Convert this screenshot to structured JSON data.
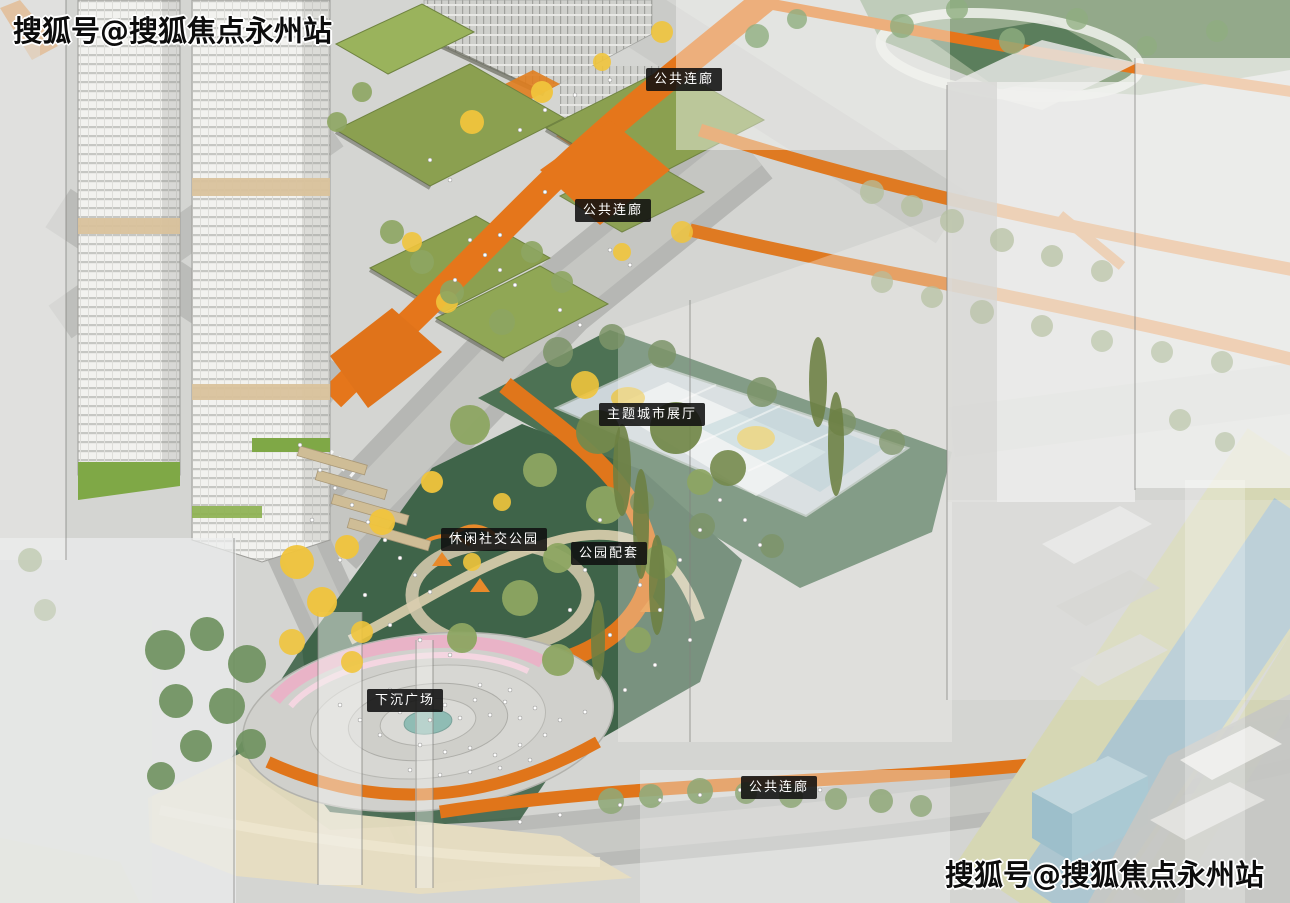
{
  "watermark": {
    "text": "搜狐号@搜狐焦点永州站"
  },
  "labels": [
    {
      "id": "public-corridor-top",
      "text": "公共连廊"
    },
    {
      "id": "public-corridor-mid",
      "text": "公共连廊"
    },
    {
      "id": "theme-city-exhibition-hall",
      "text": "主题城市展厅"
    },
    {
      "id": "leisure-social-park",
      "text": "休闲社交公园"
    },
    {
      "id": "park-amenities",
      "text": "公园配套"
    },
    {
      "id": "sunken-plaza",
      "text": "下沉广场"
    },
    {
      "id": "public-corridor-bottom",
      "text": "公共连廊"
    }
  ],
  "colors": {
    "corridor_orange": "#E5761B",
    "lawn_green": "#3F6449",
    "roof_olive": "#8BA050",
    "tree_yellow": "#F0C43C",
    "pool_glass_blue": "#CDD6DA",
    "river_blue": "#ADC6D0",
    "river_bank": "#D6D7B4",
    "plaza_pink": "#E9B3C7",
    "plaza_teal": "#8FBCB4",
    "label_bg": "#141414",
    "label_text": "#FFFFFF",
    "base_gray": "#D4D5D2"
  }
}
